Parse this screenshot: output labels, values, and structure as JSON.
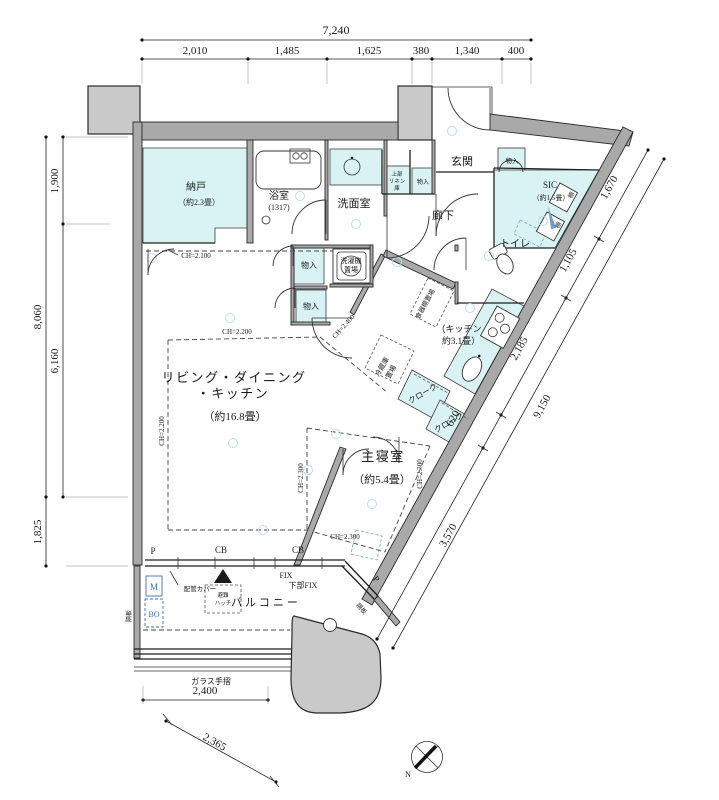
{
  "dims": {
    "top_total": "7,240",
    "top_segments": [
      "2,010",
      "1,485",
      "1,625",
      "380",
      "1,340",
      "400"
    ],
    "left_outer_upper": "8,060",
    "left_outer_lower": "1,825",
    "left_inner_upper": "1,900",
    "left_inner_lower": "6,160",
    "diag_total": "9,150",
    "diag_seg1": "1,670",
    "diag_seg2": "1,105",
    "diag_seg3": "2,185",
    "diag_seg4": "620",
    "diag_seg5": "3,570",
    "balcony_width": "2,400",
    "balcony_diag": "2,365"
  },
  "rooms": {
    "ldk_line1": "リビング・ダイニング",
    "ldk_line2": "・キッチン",
    "ldk_size": "（約16.8畳）",
    "bedroom": "主寝室",
    "bedroom_size": "（約5.4畳）",
    "nando": "納戸",
    "nando_size": "（約2.3畳）",
    "bath": "浴室",
    "bath_size": "(1317)",
    "washroom": "洗面室",
    "genkan": "玄関",
    "sic": "SIC",
    "sic_size": "（約1.5畳）",
    "hallway": "廊下",
    "toilet": "トイレ",
    "kitchen_line1": "（キッチン",
    "kitchen_line2": "約3.1畳）",
    "balcony": "バルコニー"
  },
  "storage": {
    "monoire": "物入",
    "linen1": "上部",
    "linen2": "リネン",
    "linen3": "庫",
    "cloak": "クローク",
    "shelf": "棚",
    "washer1": "洗濯機",
    "washer2": "置場",
    "fridge1": "冷蔵庫",
    "fridge2": "置場",
    "cupboard": "食器棚置場"
  },
  "ch": {
    "nando": "CH=2.100",
    "ldk_top": "CH=2.200",
    "ldk_left": "CH=2.200",
    "hall": "CH=2.400",
    "bed_left": "CH=2.300",
    "bed_right": "CH=2.300",
    "bed_bottom": "CH=2.300"
  },
  "marks": {
    "p": "P",
    "cb": "CB",
    "fix": "FIX",
    "fix_lower": "下部FIX",
    "pipe_cover": "配管カバー",
    "partition": "隔板",
    "hatch1": "避難",
    "hatch2": "ハッチ",
    "meter": "M",
    "bo": "BO",
    "glass_rail": "ガラス手摺",
    "north": "N"
  }
}
